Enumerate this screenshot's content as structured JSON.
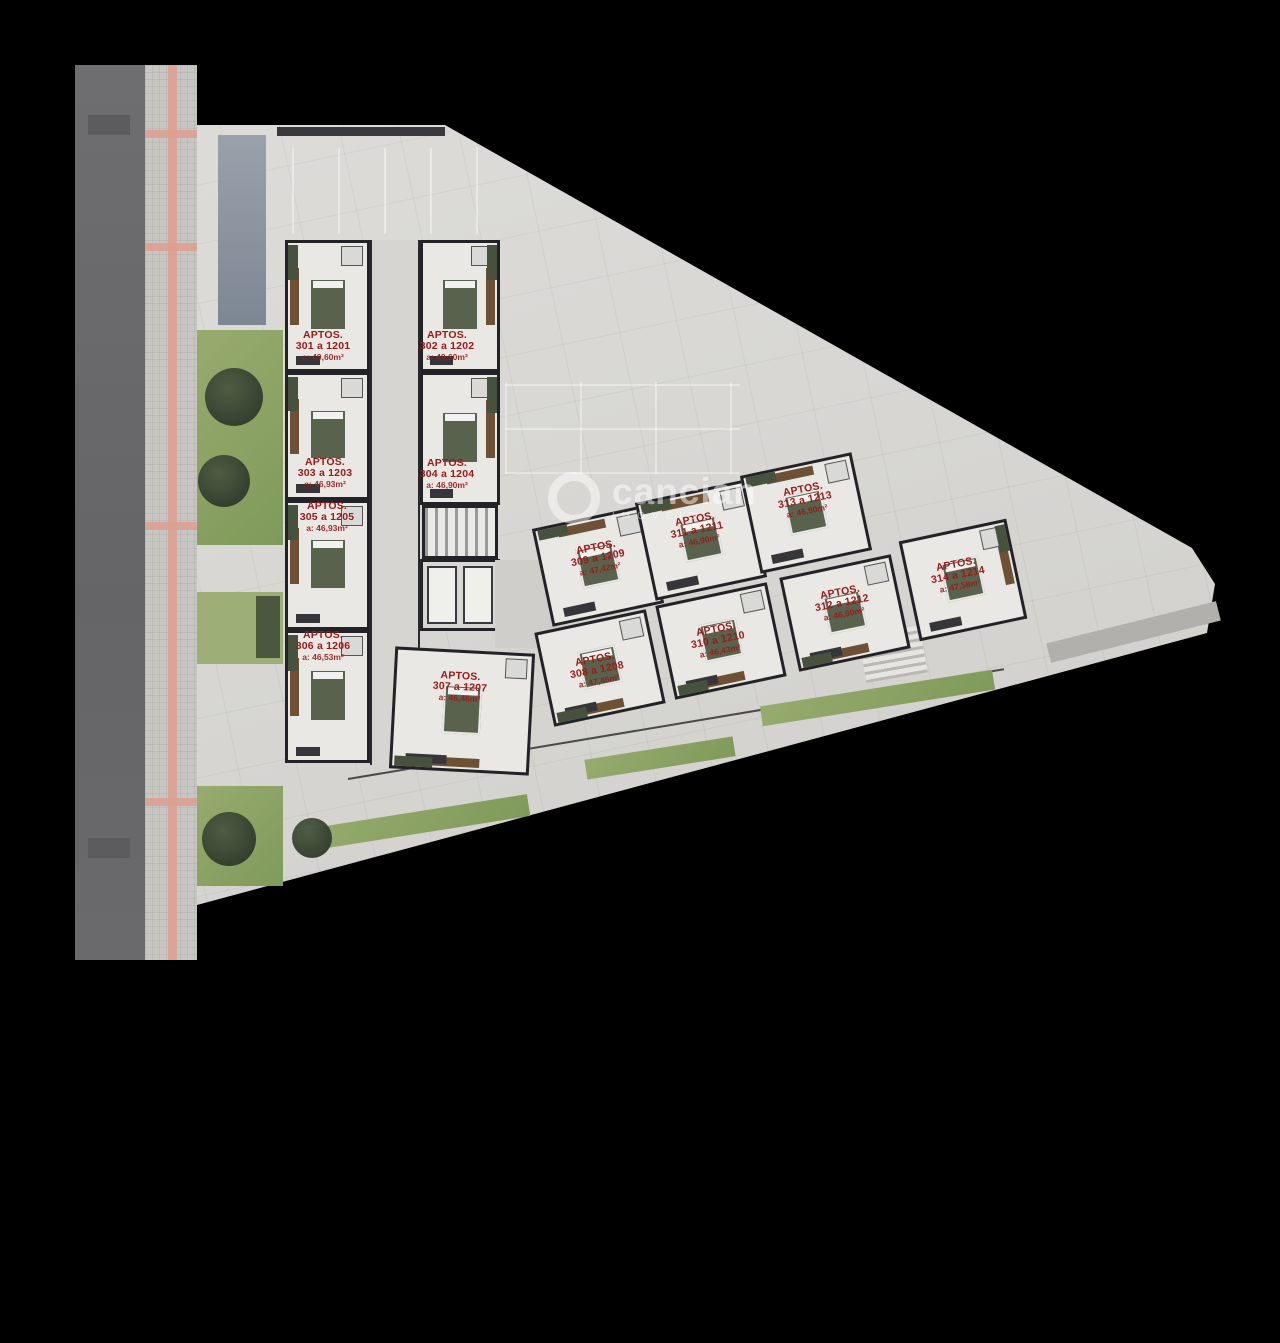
{
  "watermark": {
    "brand": "cancian",
    "sub": "IMÓVEIS"
  },
  "colors": {
    "unit_label": "#9a1a1a",
    "accent_stripe": "#dca091",
    "lot": "#d8d7d4",
    "walls": "#232327"
  },
  "units": [
    {
      "name": "APTOS.",
      "range": "301 a 1201",
      "area": "a: 49,60m²"
    },
    {
      "name": "APTOS.",
      "range": "302 a 1202",
      "area": "a: 49,60m²"
    },
    {
      "name": "APTOS.",
      "range": "303 a 1203",
      "area": "a: 46,93m²"
    },
    {
      "name": "APTOS.",
      "range": "304 a 1204",
      "area": "a: 46,90m²"
    },
    {
      "name": "APTOS.",
      "range": "305 a 1205",
      "area": "a: 46,93m²"
    },
    {
      "name": "APTOS.",
      "range": "306 a 1206",
      "area": "a: 46,53m²"
    },
    {
      "name": "APTOS.",
      "range": "307 a 1207",
      "area": "a: 46,46m²"
    },
    {
      "name": "APTOS.",
      "range": "308 a 1208",
      "area": "a: 47,46m²"
    },
    {
      "name": "APTOS.",
      "range": "309 a 1209",
      "area": "a: 47,42m²"
    },
    {
      "name": "APTOS.",
      "range": "310 a 1210",
      "area": "a: 46,43m²"
    },
    {
      "name": "APTOS.",
      "range": "311 a 1211",
      "area": "a: 46,90m²"
    },
    {
      "name": "APTOS.",
      "range": "312 a 1212",
      "area": "a: 46,90m²"
    },
    {
      "name": "APTOS.",
      "range": "313 a 1213",
      "area": "a: 46,90m²"
    },
    {
      "name": "APTOS.",
      "range": "314 a 1214",
      "area": "a: 47,58m²"
    }
  ]
}
